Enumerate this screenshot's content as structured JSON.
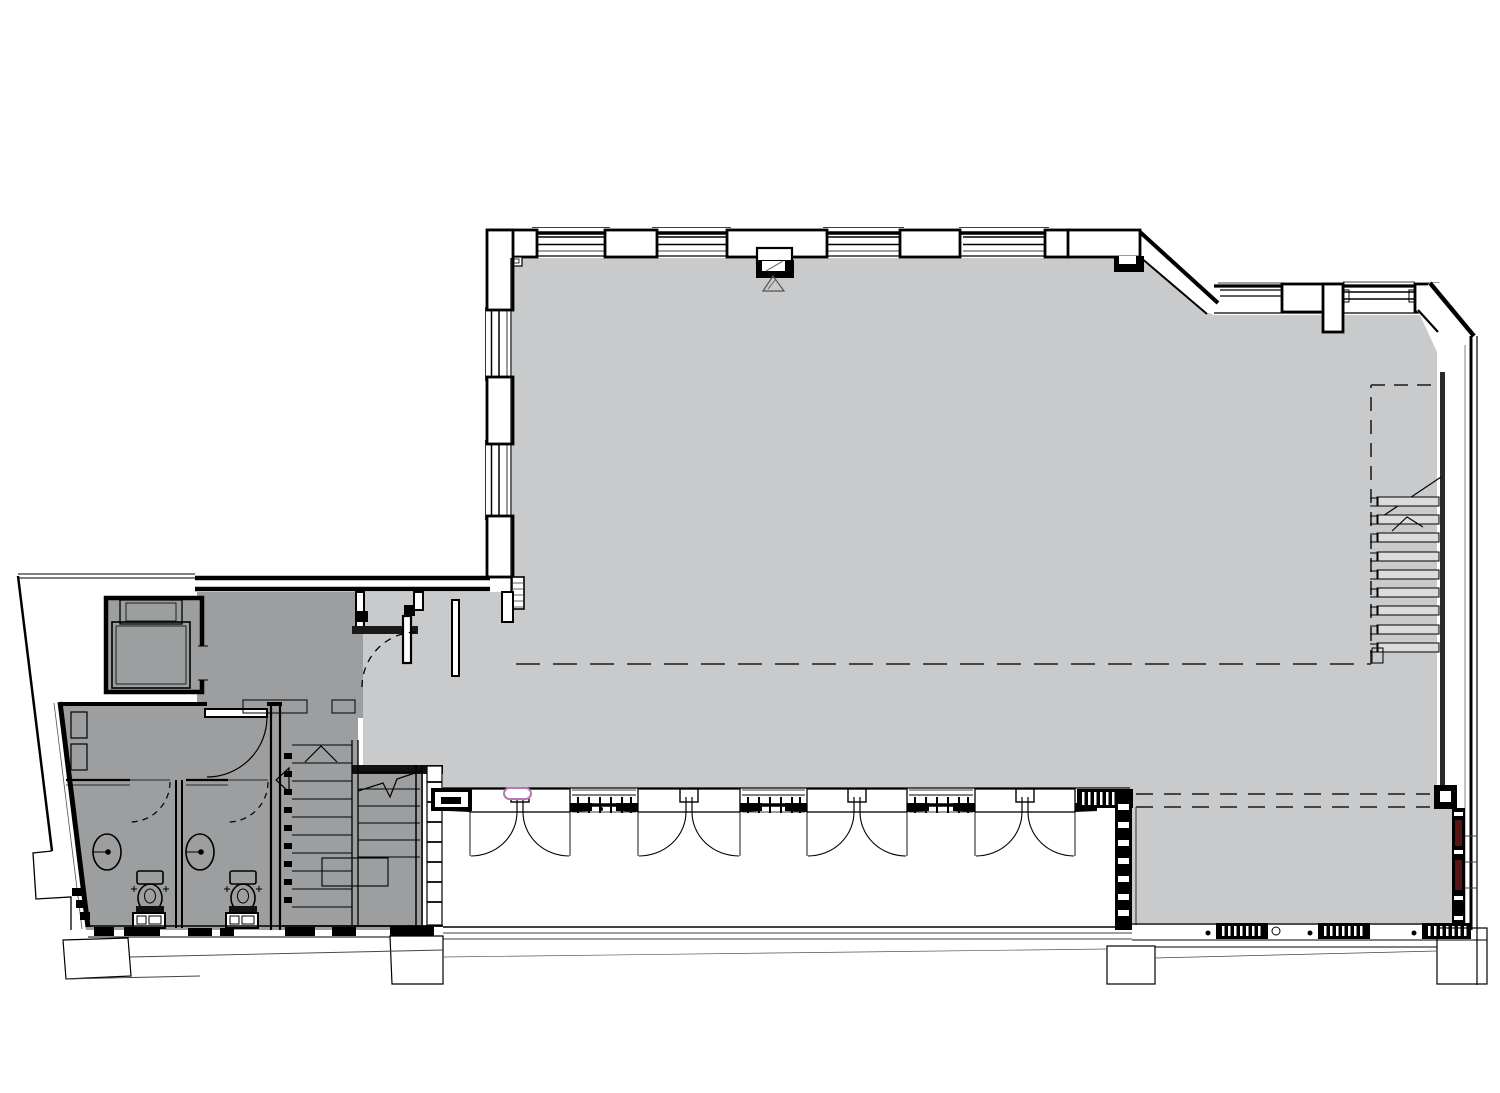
{
  "document": {
    "type": "architectural-floor-plan",
    "description": "Ground floor plan line drawing: large open floor area, WC core with two cubicles, lift, dog-leg stair core, glazed shopfront with four double-door entrances, secondary stair on right wall",
    "visible_text": ""
  },
  "colors": {
    "background": "#ffffff",
    "main_space": "#c8cacb",
    "core": "#9c9e9f",
    "line": "#000000",
    "dark_wall": "#1a1a1a",
    "tread_fill": "#dcdcdc",
    "dash_gray": "#333333",
    "soft_gray": "#555555",
    "highlight": "#b478b4",
    "accent_dark_red": "#591515"
  },
  "regions": {
    "main_space": "open plan floor area",
    "lobby": "entrance lobby",
    "wc_area": "two WC cubicles with basins and toilets",
    "lift": "lift shaft",
    "stair_core": "dog-leg staircase",
    "right_stair": "secondary stair against east wall",
    "lower_right_room": "recessed floor area at south-east"
  },
  "inventory": {
    "entrance_double_doors": 4,
    "wc_cubicles": 2,
    "basins": 2,
    "toilets": 2,
    "lifts": 1,
    "stairs": 2,
    "top_windows": 6,
    "west_windows": 2,
    "heater_blocks": 3
  }
}
